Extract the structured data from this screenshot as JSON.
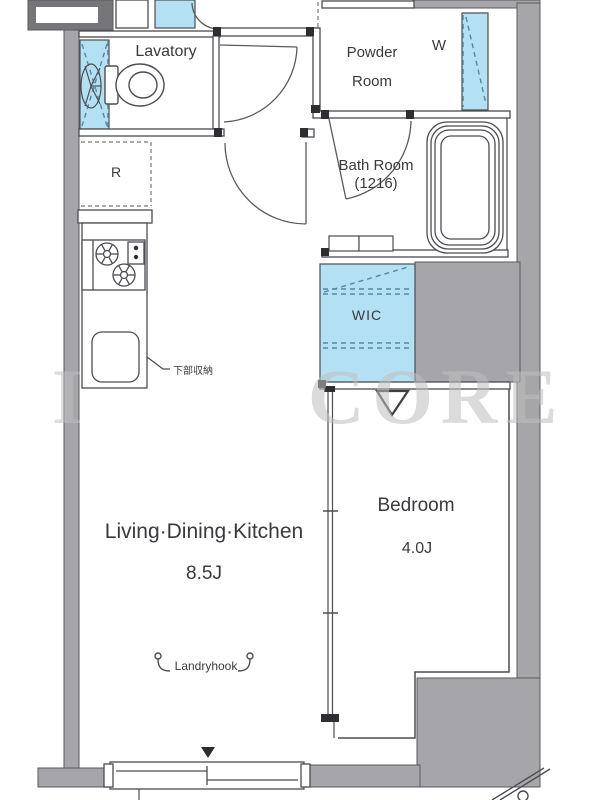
{
  "floorplan": {
    "type": "apartment-floor-plan",
    "rooms": {
      "lavatory": {
        "label": "Lavatory"
      },
      "powder_room": {
        "label_line1": "Powder",
        "label_line2": "Room"
      },
      "washer": {
        "label": "W"
      },
      "bath_room": {
        "label": "Bath Room",
        "size_label": "(1216)"
      },
      "refrigerator": {
        "label": "R"
      },
      "wic": {
        "label": "WIC"
      },
      "ldk": {
        "label": "Living·Dining·Kitchen",
        "size_label": "8.5J"
      },
      "bedroom": {
        "label": "Bedroom",
        "size_label": "4.0J"
      }
    },
    "annotations": {
      "lower_storage": {
        "label": "下部収納"
      },
      "laundry_hook": {
        "label": "Landryhook"
      }
    },
    "watermark": {
      "fragment_left": "I",
      "text": "CORE"
    },
    "colors": {
      "wall_fill": "#a6a6aa",
      "wall_dark": "#76767a",
      "line": "#4c4c52",
      "highlight_cyan": "#b3e1f3",
      "text": "#3a3a3e",
      "watermark": "#bfbfbf"
    }
  }
}
